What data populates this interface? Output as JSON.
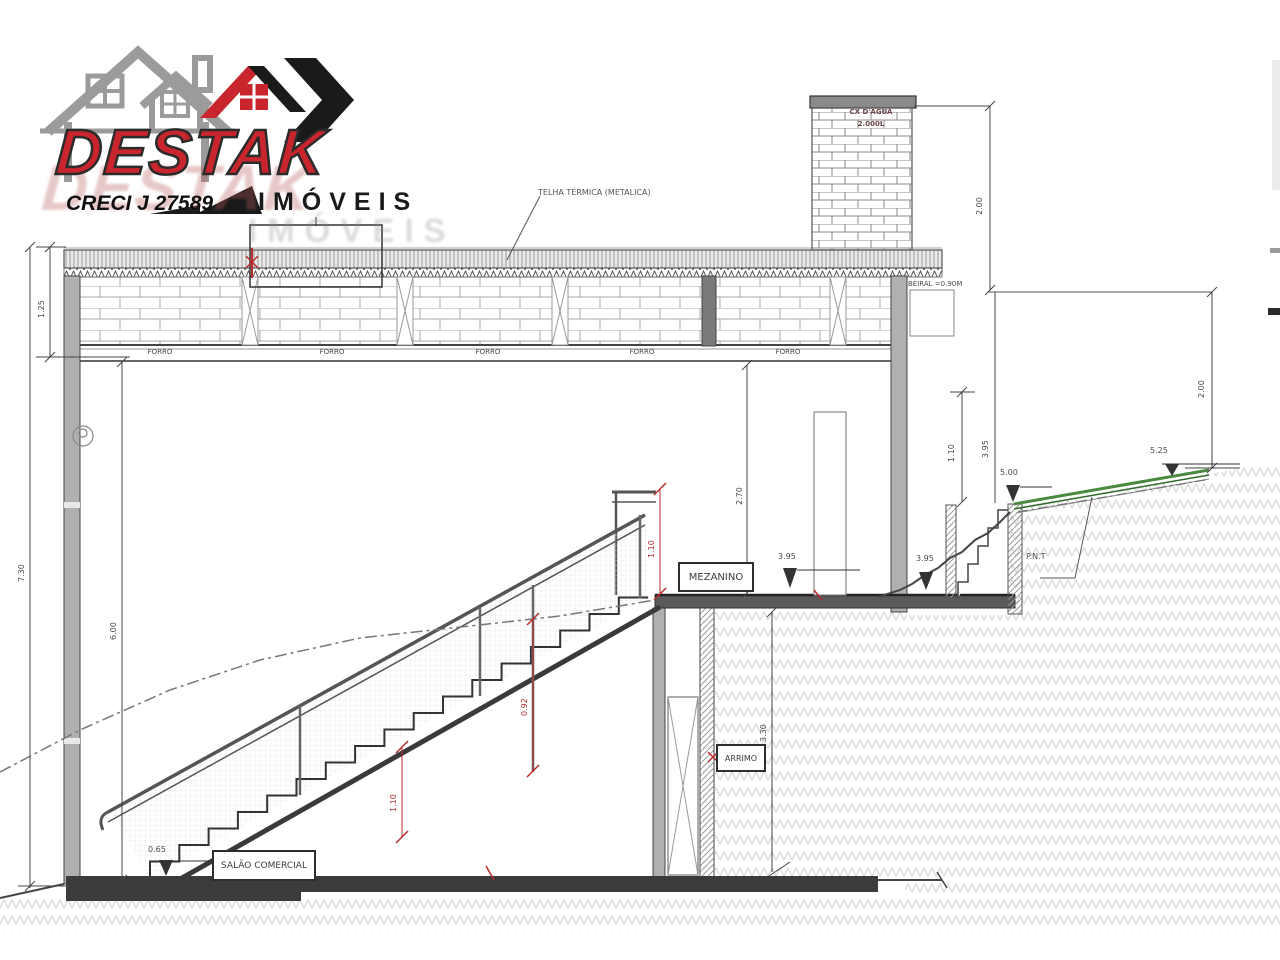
{
  "logo": {
    "brand": "DESTAK",
    "brand_shadow": "DESTAK",
    "subtitle": "IMÓVEIS",
    "subtitle_shadow": "IMÓVEIS",
    "creci": "CRECI J 27589",
    "colors": {
      "red": "#c9252c",
      "black": "#1a1a1a",
      "gray_house": "#9b9b9b"
    }
  },
  "drawing": {
    "roof_label": "TELHA TÉRMICA (METALICA)",
    "tank_line1": "CX D'ÁGUA",
    "tank_line2": "2.000L",
    "eave_label": "BEIRAL =0.90M",
    "forro_labels": [
      "FORRO",
      "FORRO",
      "FORRO",
      "FORRO",
      "FORRO"
    ],
    "rooms": {
      "mezzanine": "MEZANINO",
      "retaining": "ARRIMO",
      "hall": "SALÃO COMERCIAL",
      "pnt": "P.N.T"
    },
    "dims": {
      "band": "1.25",
      "total": "7.30",
      "hall": "6.00",
      "mezz_clear": "2.70",
      "rail_top": "1.10",
      "rail_mid": "0.92",
      "rail_low": "1.10",
      "arrimo": "3.30",
      "ext_rail": "1.10",
      "ext_offset": "3.95",
      "tank": "2.00",
      "right_drop": "2.00"
    },
    "levels": {
      "hall": "0.65",
      "mezz": "3.95",
      "ground_right": "3.95",
      "terrace": "5.00",
      "top": "5.25"
    }
  }
}
